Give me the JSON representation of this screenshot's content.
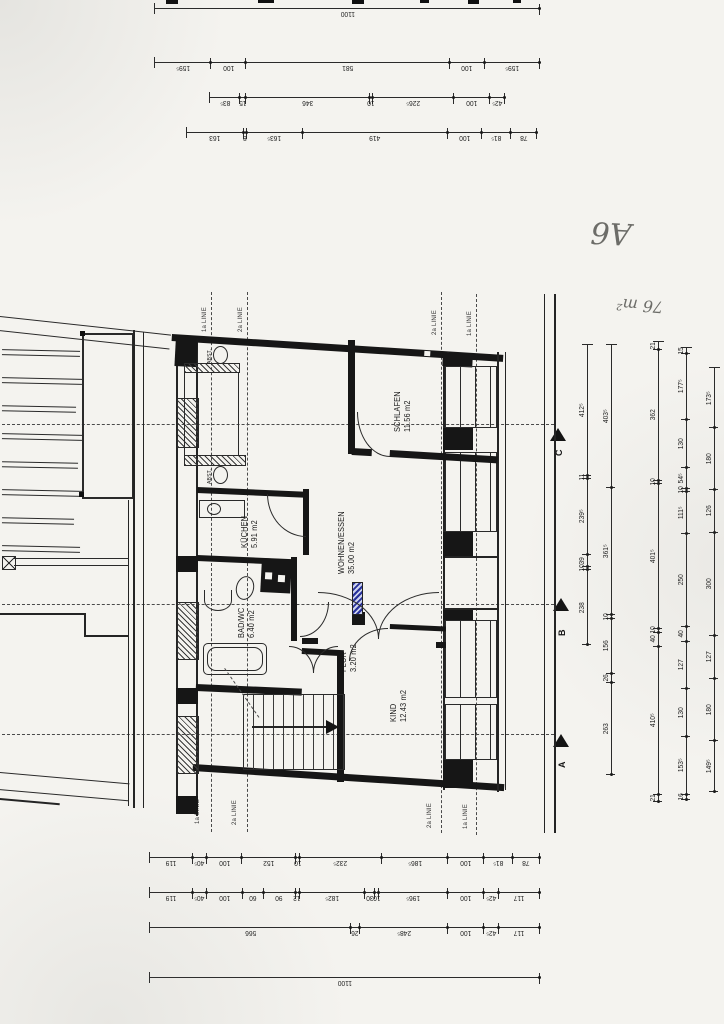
{
  "annotations": {
    "sheet_label": "A6",
    "area_note": "76 m²"
  },
  "linie_labels": {
    "first": "1a LINIE",
    "second": "2a LINIE"
  },
  "section_markers": {
    "c": "C",
    "b": "B",
    "a": "A"
  },
  "rooms": [
    {
      "name": "SCHLAFEN",
      "area": "11.56 m2"
    },
    {
      "name": "WOHNEN/ESSEN",
      "area": "35.00 m2"
    },
    {
      "name": "KÜCHEN",
      "area": "5.91 m2"
    },
    {
      "name": "BAD/WC",
      "area": "6.40 m2"
    },
    {
      "name": "FLUR",
      "area": "3.20 m2"
    },
    {
      "name": "KIND",
      "area": "12.43 m2"
    },
    {
      "name": "ABST.",
      "area": ""
    },
    {
      "name": "ABST.",
      "area": ""
    }
  ],
  "dimensions": {
    "top_block": [
      [
        {
          "t": "1100",
          "w": 1100
        }
      ],
      [
        {
          "t": "159⁵",
          "w": 159.5
        },
        {
          "t": "100",
          "w": 100
        },
        {
          "t": "581",
          "w": 581
        },
        {
          "t": "100",
          "w": 100
        },
        {
          "t": "159⁵",
          "w": 159.5
        }
      ],
      [
        {
          "t": "42⁵",
          "w": 42.5
        },
        {
          "t": "100",
          "w": 100
        },
        {
          "t": "226⁵",
          "w": 226.5
        },
        {
          "t": "10",
          "w": 10
        },
        {
          "t": "346",
          "w": 346
        },
        {
          "t": "15",
          "w": 15
        },
        {
          "t": "83⁵",
          "w": 83.5
        }
      ],
      [
        {
          "t": "78",
          "w": 78
        },
        {
          "t": "81⁵",
          "w": 81.5
        },
        {
          "t": "100",
          "w": 100
        },
        {
          "t": "419",
          "w": 419
        },
        {
          "t": "163⁵",
          "w": 163.5
        },
        {
          "t": "8",
          "w": 8
        },
        {
          "t": "163",
          "w": 163
        }
      ]
    ],
    "bottom_block": [
      [
        {
          "t": "78",
          "w": 78
        },
        {
          "t": "81⁵",
          "w": 81.5
        },
        {
          "t": "100",
          "w": 100
        },
        {
          "t": "186⁵",
          "w": 186.5
        },
        {
          "t": "232⁵",
          "w": 232.5
        },
        {
          "t": "10",
          "w": 10
        },
        {
          "t": "152",
          "w": 152
        },
        {
          "t": "100",
          "w": 100
        },
        {
          "t": "40⁵",
          "w": 40.5
        },
        {
          "t": "119",
          "w": 119
        }
      ],
      [
        {
          "t": "117",
          "w": 117
        },
        {
          "t": "42⁵",
          "w": 42.5
        },
        {
          "t": "100",
          "w": 100
        },
        {
          "t": "196⁵",
          "w": 196.5
        },
        {
          "t": "10",
          "w": 10
        },
        {
          "t": "30",
          "w": 30
        },
        {
          "t": "182⁵",
          "w": 182.5
        },
        {
          "t": "12",
          "w": 12
        },
        {
          "t": "90",
          "w": 90
        },
        {
          "t": "60",
          "w": 60
        },
        {
          "t": "100",
          "w": 100
        },
        {
          "t": "40⁵",
          "w": 40.5
        },
        {
          "t": "119",
          "w": 119
        }
      ],
      [
        {
          "t": "117",
          "w": 117
        },
        {
          "t": "42⁵",
          "w": 42.5
        },
        {
          "t": "100",
          "w": 100
        },
        {
          "t": "248⁵",
          "w": 248.5
        },
        {
          "t": "26",
          "w": 26
        },
        {
          "t": "566",
          "w": 566
        }
      ],
      [
        {
          "t": "1100",
          "w": 1100
        }
      ]
    ],
    "right_chains": [
      [
        {
          "t": "238",
          "w": 238
        },
        {
          "t": "10",
          "w": 10
        },
        {
          "t": "39",
          "w": 39
        },
        {
          "t": "239⁵",
          "w": 239.5
        },
        {
          "t": "11",
          "w": 11
        },
        {
          "t": "412⁵",
          "w": 412.5
        }
      ],
      [
        {
          "t": "263",
          "w": 263
        },
        {
          "t": "26",
          "w": 26
        },
        {
          "t": "156",
          "w": 156
        },
        {
          "t": "10",
          "w": 10
        },
        {
          "t": "361⁵",
          "w": 361.5
        },
        {
          "t": "403⁵",
          "w": 403.5
        }
      ],
      [
        {
          "t": "21",
          "w": 21
        },
        {
          "t": "410⁵",
          "w": 410.5
        },
        {
          "t": "40",
          "w": 40
        },
        {
          "t": "10",
          "w": 10
        },
        {
          "t": "401⁵",
          "w": 401.5
        },
        {
          "t": "10",
          "w": 10
        },
        {
          "t": "362",
          "w": 362
        },
        {
          "t": "21",
          "w": 21
        }
      ],
      [
        {
          "t": "16",
          "w": 16
        },
        {
          "t": "153⁵",
          "w": 153.5
        },
        {
          "t": "130",
          "w": 130
        },
        {
          "t": "127",
          "w": 127
        },
        {
          "t": "40",
          "w": 40
        },
        {
          "t": "250",
          "w": 250
        },
        {
          "t": "111⁵",
          "w": 111.5
        },
        {
          "t": "10",
          "w": 10
        },
        {
          "t": "54⁵",
          "w": 54.5
        },
        {
          "t": "130",
          "w": 130
        },
        {
          "t": "177⁵",
          "w": 177.5
        },
        {
          "t": "15",
          "w": 15
        }
      ],
      [
        {
          "t": "149⁵",
          "w": 149.5
        },
        {
          "t": "180",
          "w": 180
        },
        {
          "t": "127",
          "w": 127
        },
        {
          "t": "300",
          "w": 300
        },
        {
          "t": "126",
          "w": 126
        },
        {
          "t": "180",
          "w": 180
        },
        {
          "t": "173⁵",
          "w": 173.5
        }
      ]
    ]
  }
}
